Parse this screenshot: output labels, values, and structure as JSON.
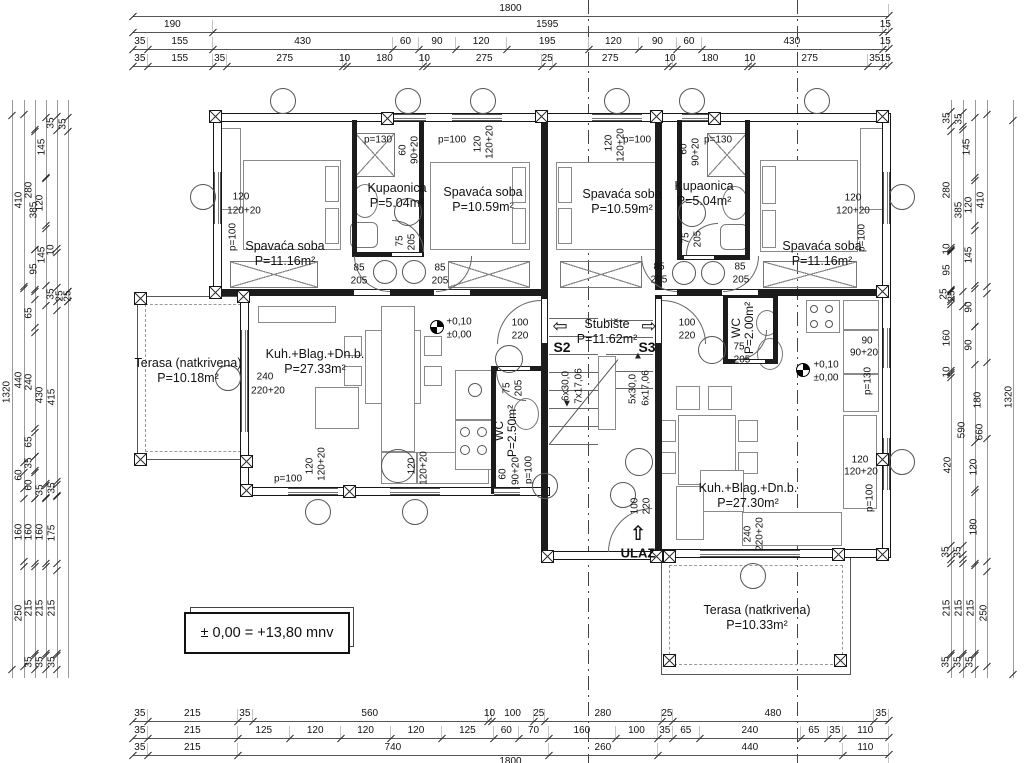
{
  "drawing": {
    "note_box": "± 0,00 = +13,80 mnv",
    "entrance_label": "ULAZ",
    "marker_s2": "S2",
    "marker_s3": "S3"
  },
  "rooms": [
    {
      "name": "Spavaća soba",
      "area": "P=11.16m²",
      "x": 285,
      "y": 254,
      "rot": 0
    },
    {
      "name": "Kupaonica",
      "area": "P=5.04m²",
      "x": 397,
      "y": 196,
      "rot": 0
    },
    {
      "name": "Spavaća soba",
      "area": "P=10.59m²",
      "x": 483,
      "y": 200,
      "rot": 0
    },
    {
      "name": "Spavaća soba",
      "area": "P=10.59m²",
      "x": 622,
      "y": 202,
      "rot": 0
    },
    {
      "name": "Kupaonica",
      "area": "P=5.04m²",
      "x": 704,
      "y": 194,
      "rot": 0
    },
    {
      "name": "Spavaća soba",
      "area": "P=11.16m²",
      "x": 822,
      "y": 254,
      "rot": 0
    },
    {
      "name": "Kuh.+Blag.+Dn.b.",
      "area": "P=27.33m²",
      "x": 315,
      "y": 362,
      "rot": 0
    },
    {
      "name": "Kuh.+Blag.+Dn.b.",
      "area": "P=27.30m²",
      "x": 748,
      "y": 496,
      "rot": 0
    },
    {
      "name": "Terasa (natkrivena)",
      "area": "P=10.18m²",
      "x": 188,
      "y": 371,
      "rot": 0
    },
    {
      "name": "Terasa (natkrivena)",
      "area": "P=10.33m²",
      "x": 757,
      "y": 618,
      "rot": 0
    },
    {
      "name": "Stubište",
      "area": "P=11.62m²",
      "x": 607,
      "y": 332,
      "rot": 0
    },
    {
      "name": "WC",
      "area": "P=2.50m²",
      "x": 506,
      "y": 431,
      "rot": 1
    },
    {
      "name": "WC",
      "area": "P=2.00m²",
      "x": 743,
      "y": 328,
      "rot": 1
    }
  ],
  "stair_labels": [
    {
      "t": "6x30,0",
      "x": 566,
      "y": 386
    },
    {
      "t": "7x17,06",
      "x": 579,
      "y": 386
    },
    {
      "t": "5x30,0",
      "x": 633,
      "y": 389
    },
    {
      "t": "6x17,06",
      "x": 646,
      "y": 388
    }
  ],
  "plan_labels": [
    [
      "120",
      241,
      197,
      0
    ],
    [
      "120+20",
      244,
      211,
      0
    ],
    [
      "p=100",
      233,
      237,
      1
    ],
    [
      "p=130",
      378,
      140,
      0
    ],
    [
      "60",
      403,
      150,
      1
    ],
    [
      "90+20",
      415,
      150,
      1
    ],
    [
      "p=100",
      452,
      140,
      0
    ],
    [
      "120",
      478,
      144,
      1
    ],
    [
      "120+20",
      490,
      142,
      1
    ],
    [
      "120",
      609,
      143,
      1
    ],
    [
      "120+20",
      621,
      145,
      1
    ],
    [
      "p=100",
      637,
      140,
      0
    ],
    [
      "60",
      684,
      149,
      1
    ],
    [
      "90+20",
      696,
      152,
      1
    ],
    [
      "p=130",
      718,
      140,
      0
    ],
    [
      "120",
      853,
      198,
      0
    ],
    [
      "120+20",
      853,
      211,
      0
    ],
    [
      "p=100",
      862,
      238,
      1
    ],
    [
      "75",
      400,
      241,
      1
    ],
    [
      "205",
      412,
      242,
      1
    ],
    [
      "75",
      686,
      238,
      1
    ],
    [
      "205",
      698,
      239,
      1
    ],
    [
      "85",
      359,
      268,
      0
    ],
    [
      "205",
      359,
      281,
      0
    ],
    [
      "85",
      440,
      268,
      0
    ],
    [
      "205",
      440,
      281,
      0
    ],
    [
      "85",
      659,
      267,
      0
    ],
    [
      "205",
      659,
      280,
      0
    ],
    [
      "85",
      740,
      267,
      0
    ],
    [
      "205",
      741,
      280,
      0
    ],
    [
      "100",
      520,
      323,
      0
    ],
    [
      "220",
      520,
      336,
      0
    ],
    [
      "100",
      687,
      323,
      0
    ],
    [
      "220",
      687,
      336,
      0
    ],
    [
      "240",
      265,
      377,
      0
    ],
    [
      "220+20",
      268,
      391,
      0
    ],
    [
      "p=100",
      288,
      479,
      0
    ],
    [
      "120",
      310,
      466,
      1
    ],
    [
      "120+20",
      322,
      464,
      1
    ],
    [
      "120",
      412,
      466,
      1
    ],
    [
      "120+20",
      424,
      468,
      1
    ],
    [
      "60",
      503,
      474,
      1
    ],
    [
      "90+20",
      516,
      471,
      1
    ],
    [
      "p=100",
      529,
      470,
      1
    ],
    [
      "75",
      507,
      388,
      1
    ],
    [
      "205",
      519,
      388,
      1
    ],
    [
      "75",
      739,
      347,
      0
    ],
    [
      "205",
      742,
      360,
      0
    ],
    [
      "90",
      867,
      341,
      0
    ],
    [
      "90+20",
      864,
      353,
      0
    ],
    [
      "p=130",
      868,
      381,
      1
    ],
    [
      "120",
      860,
      460,
      0
    ],
    [
      "120+20",
      861,
      472,
      0
    ],
    [
      "p=100",
      870,
      498,
      1
    ],
    [
      "240",
      748,
      534,
      1
    ],
    [
      "220+20",
      760,
      534,
      1
    ],
    [
      "100",
      635,
      506,
      1
    ],
    [
      "220",
      647,
      506,
      1
    ],
    [
      "+0,10",
      459,
      322,
      0
    ],
    [
      "±0,00",
      459,
      335,
      0
    ],
    [
      "+0,10",
      826,
      365,
      0
    ],
    [
      "±0,00",
      826,
      378,
      0
    ]
  ],
  "dims": {
    "origin_x": 133,
    "scale": 0.42,
    "top_rows": [
      {
        "y": 4,
        "values": [
          1800
        ]
      },
      {
        "y": 20,
        "values": [
          190,
          1595,
          15
        ]
      },
      {
        "y": 37,
        "values": [
          35,
          155,
          430,
          60,
          90,
          120,
          195,
          120,
          90,
          60,
          430,
          15
        ]
      },
      {
        "y": 54,
        "values": [
          35,
          155,
          35,
          275,
          10,
          180,
          10,
          275,
          25,
          275,
          10,
          180,
          10,
          275,
          35,
          15
        ]
      }
    ],
    "bottom_rows": [
      {
        "y": 709,
        "values": [
          35,
          215,
          35,
          560,
          10,
          100,
          25,
          280,
          25,
          480,
          35
        ]
      },
      {
        "y": 726,
        "values": [
          35,
          215,
          125,
          120,
          120,
          120,
          125,
          60,
          70,
          160,
          100,
          35,
          65,
          240,
          65,
          35,
          110
        ]
      },
      {
        "y": 743,
        "values": [
          35,
          215,
          740,
          260,
          440,
          110
        ]
      },
      {
        "y": 757,
        "values": [
          1800
        ]
      }
    ]
  },
  "side_dims": {
    "left_lines": [
      12,
      24,
      35,
      46,
      57,
      68
    ],
    "right_lines": [
      951,
      963,
      975,
      987,
      1013
    ],
    "line_top": 100,
    "line_bottom": 678,
    "left_labels": [
      [
        7,
        392,
        "1320"
      ],
      [
        19,
        200,
        "410"
      ],
      [
        19,
        380,
        "440"
      ],
      [
        19,
        475,
        "60"
      ],
      [
        19,
        532,
        "160"
      ],
      [
        19,
        613,
        "250"
      ],
      [
        29,
        190,
        "280"
      ],
      [
        29,
        382,
        "240"
      ],
      [
        29,
        442,
        "65"
      ],
      [
        29,
        463,
        "35"
      ],
      [
        29,
        485,
        "60"
      ],
      [
        29,
        532,
        "160"
      ],
      [
        29,
        608,
        "215"
      ],
      [
        29,
        662,
        "35"
      ],
      [
        29,
        313,
        "65"
      ],
      [
        34,
        210,
        "385"
      ],
      [
        34,
        269,
        "95"
      ],
      [
        40,
        203,
        "120"
      ],
      [
        40,
        395,
        "430"
      ],
      [
        40,
        490,
        "35"
      ],
      [
        40,
        532,
        "160"
      ],
      [
        40,
        608,
        "215"
      ],
      [
        40,
        662,
        "35"
      ],
      [
        42,
        147,
        "145"
      ],
      [
        42,
        255,
        "145"
      ],
      [
        51,
        123,
        "35"
      ],
      [
        51,
        250,
        "10"
      ],
      [
        51,
        294,
        "35"
      ],
      [
        52,
        397,
        "415"
      ],
      [
        52,
        488,
        "35"
      ],
      [
        52,
        533,
        "175"
      ],
      [
        52,
        608,
        "215"
      ],
      [
        52,
        662,
        "35"
      ],
      [
        63,
        124,
        "35"
      ],
      [
        60,
        296,
        "25"
      ],
      [
        68,
        296,
        "25"
      ]
    ],
    "right_labels": [
      [
        1009,
        397,
        "1320"
      ],
      [
        981,
        200,
        "410"
      ],
      [
        980,
        432,
        "660"
      ],
      [
        984,
        613,
        "250"
      ],
      [
        969,
        205,
        "120"
      ],
      [
        969,
        255,
        "145"
      ],
      [
        969,
        307,
        "90"
      ],
      [
        969,
        345,
        "90"
      ],
      [
        974,
        467,
        "120"
      ],
      [
        974,
        527,
        "180"
      ],
      [
        971,
        608,
        "215"
      ],
      [
        970,
        662,
        "35"
      ],
      [
        978,
        400,
        "180"
      ],
      [
        959,
        210,
        "385"
      ],
      [
        962,
        430,
        "590"
      ],
      [
        959,
        608,
        "215"
      ],
      [
        958,
        662,
        "35"
      ],
      [
        959,
        119,
        "35"
      ],
      [
        958,
        552,
        "35"
      ],
      [
        967,
        147,
        "145"
      ],
      [
        947,
        118,
        "35"
      ],
      [
        947,
        190,
        "280"
      ],
      [
        947,
        249,
        "10"
      ],
      [
        947,
        270,
        "95"
      ],
      [
        944,
        294,
        "25"
      ],
      [
        952,
        296,
        "25"
      ],
      [
        947,
        338,
        "160"
      ],
      [
        947,
        372,
        "10"
      ],
      [
        948,
        465,
        "420"
      ],
      [
        946,
        552,
        "35"
      ],
      [
        947,
        608,
        "215"
      ],
      [
        946,
        662,
        "35"
      ]
    ]
  }
}
